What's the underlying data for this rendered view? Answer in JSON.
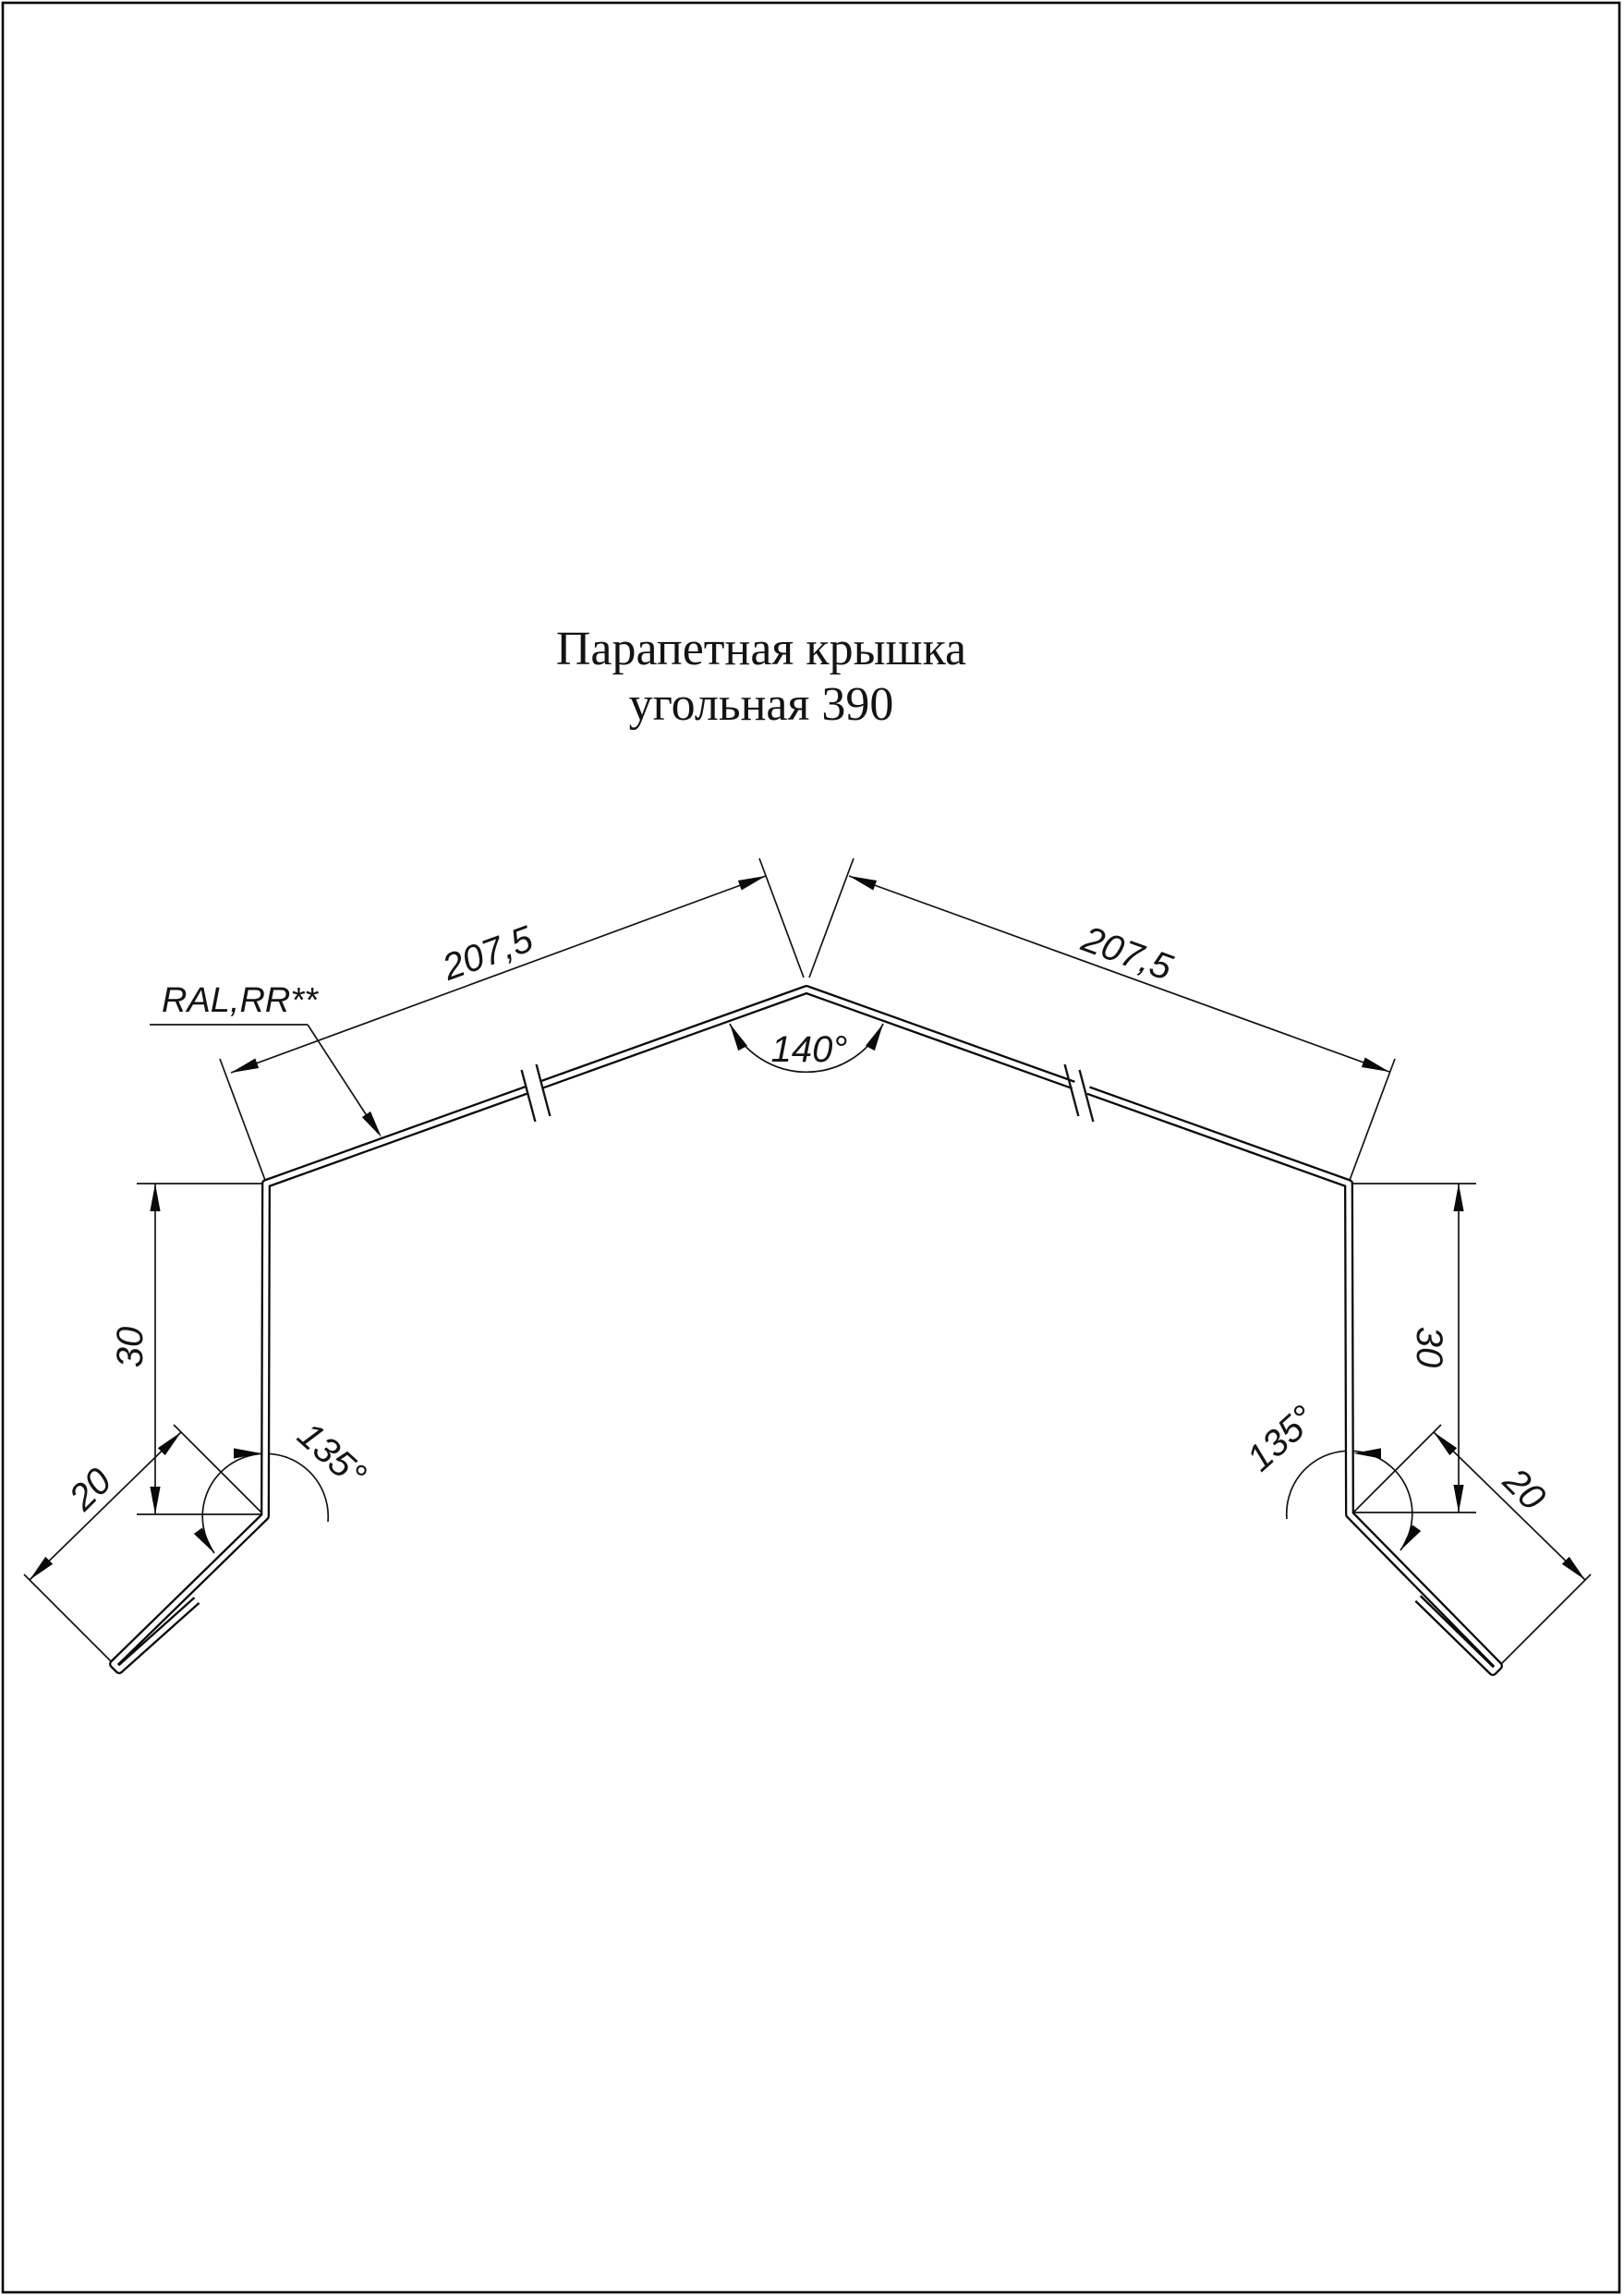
{
  "page": {
    "background": "#ffffff",
    "line_color": "#141414",
    "border_color": "#000000"
  },
  "title": {
    "line1": "Парапетная крышка",
    "line2": "угольная 390"
  },
  "material_label": {
    "text": "RAL,RR**"
  },
  "dimensions": {
    "slope_left": {
      "label": "207,5",
      "value": 207.5
    },
    "slope_right": {
      "label": "207,5",
      "value": 207.5
    },
    "apex_angle": {
      "label": "140°",
      "value": 140
    },
    "web_left": {
      "label": "30",
      "value": 30
    },
    "web_right": {
      "label": "30",
      "value": 30
    },
    "flange_left": {
      "label": "20",
      "value": 20
    },
    "flange_right": {
      "label": "20",
      "value": 20
    },
    "bend_angle_left": {
      "label": "135°",
      "value": 135
    },
    "bend_angle_right": {
      "label": "135°",
      "value": 135
    }
  }
}
